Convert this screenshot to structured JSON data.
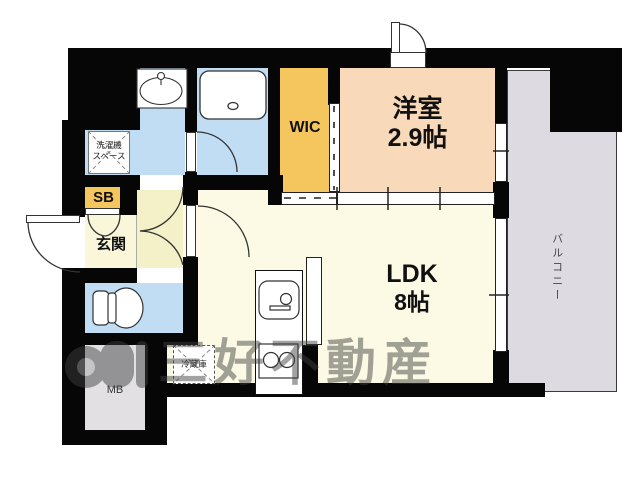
{
  "plan": {
    "watermark": {
      "text": "三好不動産",
      "color": "#3f3f3f"
    },
    "colors": {
      "wall": "#060606",
      "western_room": "#f8d9ba",
      "ldk": "#fcfae4",
      "hall": "#f4f0c8",
      "genkan": "#faf6da",
      "wet_rooms": "#c0ddf4",
      "storage": "#f5c65e",
      "balcony": "#dddbe1",
      "meter_box": "#e2e0e3"
    },
    "rooms": {
      "western": {
        "label": "洋室",
        "size": "2.9帖"
      },
      "ldk": {
        "label": "LDK",
        "size": "8帖"
      },
      "wic": {
        "label": "WIC"
      },
      "genkan": {
        "label": "玄関"
      },
      "balcony": {
        "label": "バルコニー"
      },
      "sb": {
        "label": "SB"
      },
      "mb": {
        "label": "MB"
      },
      "laundry": {
        "label_line1": "洗濯機",
        "label_line2": "スペース"
      },
      "fridge": {
        "label": "冷蔵庫"
      }
    }
  }
}
